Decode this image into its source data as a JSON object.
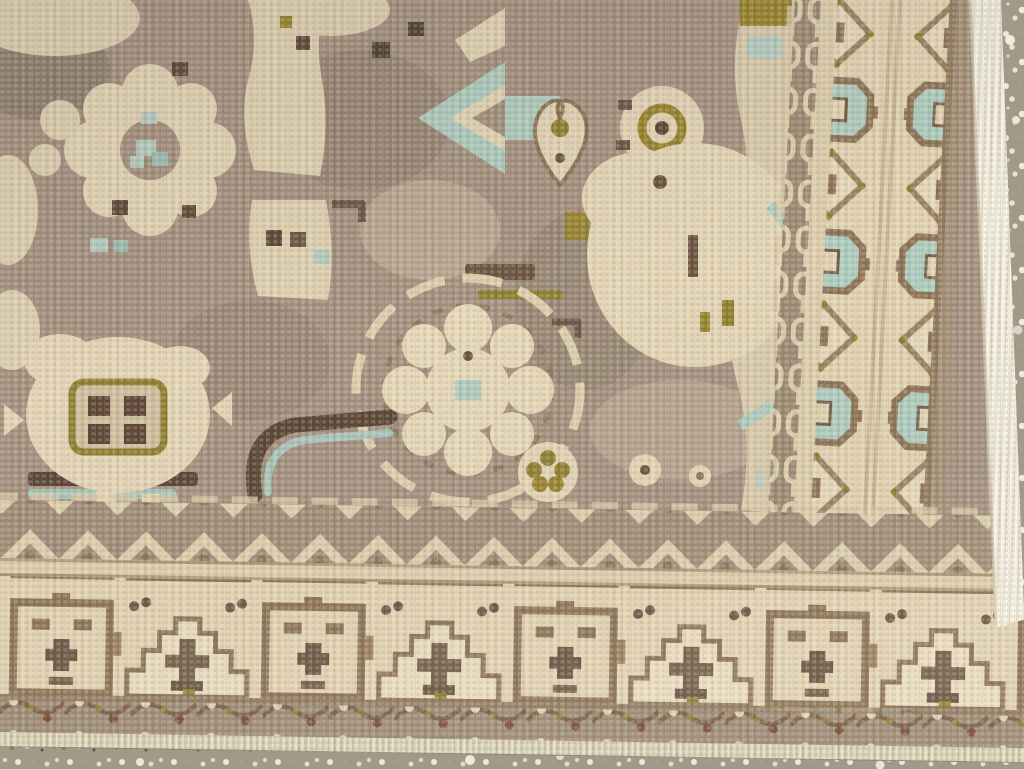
{
  "scene": {
    "title": "Corner detail of a vintage hand-knotted wool rug on a speckled terrazzo floor",
    "description": "Close-up photograph of the bottom-right corner of a vintage hand-knotted rug. A greyish-taupe field carries cream geometric palmettes and rosettes with pale aqua-blue and olive-green accents. The field is framed by geometric minor and main borders in cream and brown, finished with a white fringed selvage along the right edge and a ribbed cream cord along the bottom edge. A grey terrazzo floor with white, pink and dark speckles shows beyond the rug edges.",
    "objects": [
      "rug-field",
      "rug-borders",
      "rug-fringe",
      "rug-edge-cord",
      "terrazzo-floor"
    ]
  },
  "rug": {
    "field": {
      "ground": "taupe",
      "motifs": [
        "octofoil-rosette",
        "window-gul",
        "vertical-cream-panel",
        "central-rosette",
        "dark-hook",
        "aqua-arrow",
        "heart-palmette",
        "olive-ring",
        "large-palmette",
        "aqua-crescent",
        "olive-flower-cluster",
        "scattered-squares"
      ]
    },
    "borders": [
      {
        "name": "inner-zigzag-guard",
        "position": "bottom"
      },
      {
        "name": "main-border-frame-and-arch",
        "position": "bottom"
      },
      {
        "name": "outer-vine-guard",
        "position": "bottom"
      },
      {
        "name": "chain-guard",
        "position": "right"
      },
      {
        "name": "main-border-diamond-and-stepped-gul",
        "position": "right"
      }
    ],
    "edges": {
      "right": "white-fringe-selvage",
      "bottom": "cream-ribbed-cord"
    }
  },
  "floor": {
    "material": "terrazzo-concrete",
    "speckles": [
      "white",
      "light-grey",
      "pink",
      "brown",
      "dark-olive"
    ]
  },
  "palette": {
    "field_taupe": "#a49180",
    "motif_cream": "#e3d5b6",
    "border_ground_cream": "#e2d3b3",
    "border_brown": "#8d7458",
    "dark_brown": "#5a4636",
    "accent_aqua": "#aecdc0",
    "accent_olive": "#8f8030",
    "vine_taupe": "#9c8a75",
    "cord_cream": "#dad3b8",
    "fringe_white": "#f2edde",
    "floor_base": "#a29a88",
    "floor_speck_light": "#ece7d9",
    "floor_speck_dark": "#55534a",
    "floor_speck_pink": "#c2a493",
    "floor_speck_brown": "#8a6a55"
  }
}
